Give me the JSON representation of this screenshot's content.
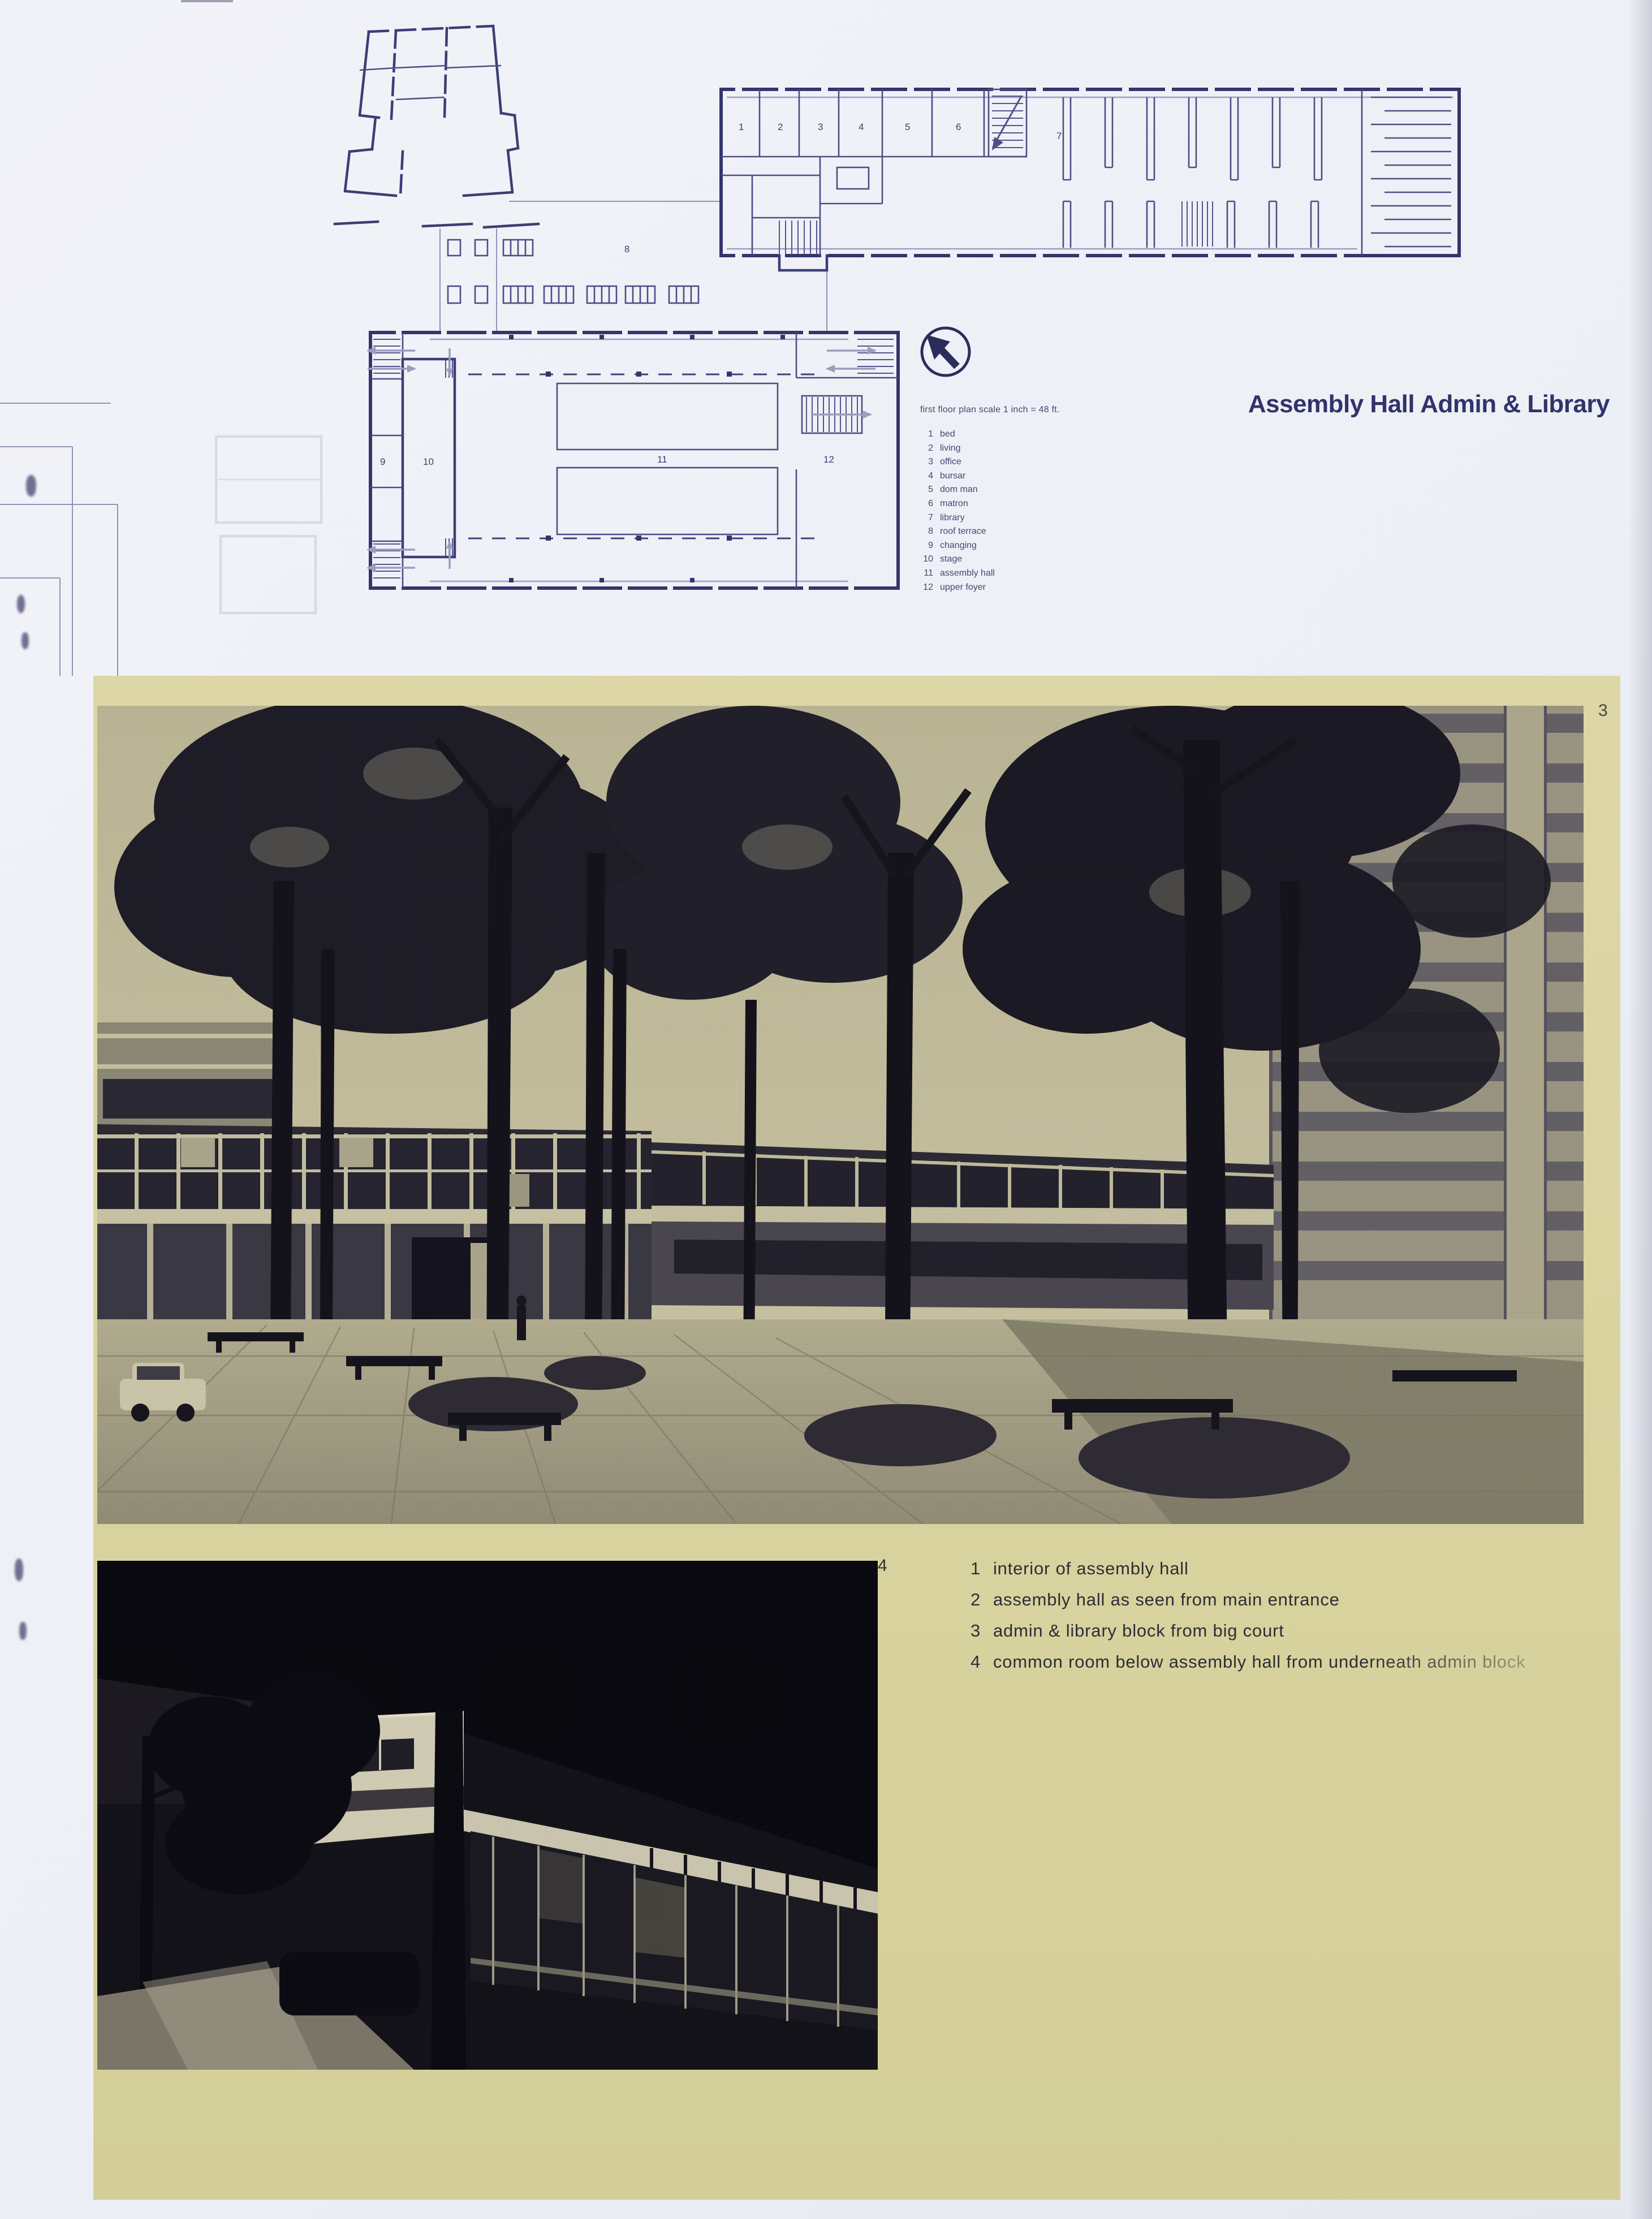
{
  "document": {
    "kind": "scanned architecture book page",
    "title": "Assembly Hall Admin & Library",
    "plan_scale_note": "first floor plan scale 1 inch = 48 ft.",
    "legend": [
      {
        "num": "1",
        "label": "bed"
      },
      {
        "num": "2",
        "label": "living"
      },
      {
        "num": "3",
        "label": "office"
      },
      {
        "num": "4",
        "label": "bursar"
      },
      {
        "num": "5",
        "label": "dom man"
      },
      {
        "num": "6",
        "label": "matron"
      },
      {
        "num": "7",
        "label": "library"
      },
      {
        "num": "8",
        "label": "roof terrace"
      },
      {
        "num": "9",
        "label": "changing"
      },
      {
        "num": "10",
        "label": "stage"
      },
      {
        "num": "11",
        "label": "assembly hall"
      },
      {
        "num": "12",
        "label": "upper foyer"
      }
    ],
    "plan_labels": [
      "1",
      "2",
      "3",
      "4",
      "5",
      "6",
      "7",
      "8",
      "9",
      "10",
      "11",
      "12"
    ],
    "photo_labels": {
      "big": "3",
      "small": "4"
    },
    "captions": [
      {
        "num": "1",
        "text": "interior of assembly hall"
      },
      {
        "num": "2",
        "text": "assembly hall as seen from main entrance"
      },
      {
        "num": "3",
        "text": "admin & library block from big court"
      },
      {
        "num": "4",
        "text": "common room below assembly hall from underneath admin block"
      }
    ],
    "colors": {
      "page_bg": "#edeff6",
      "plan_ink": "#34366b",
      "title_ink": "#31336a",
      "panel_yellow": "#dbd5a2",
      "photo_shadow": "#17151e",
      "photo_highlight": "#cdc8a8",
      "caption_ink": "#2e2d35"
    }
  }
}
